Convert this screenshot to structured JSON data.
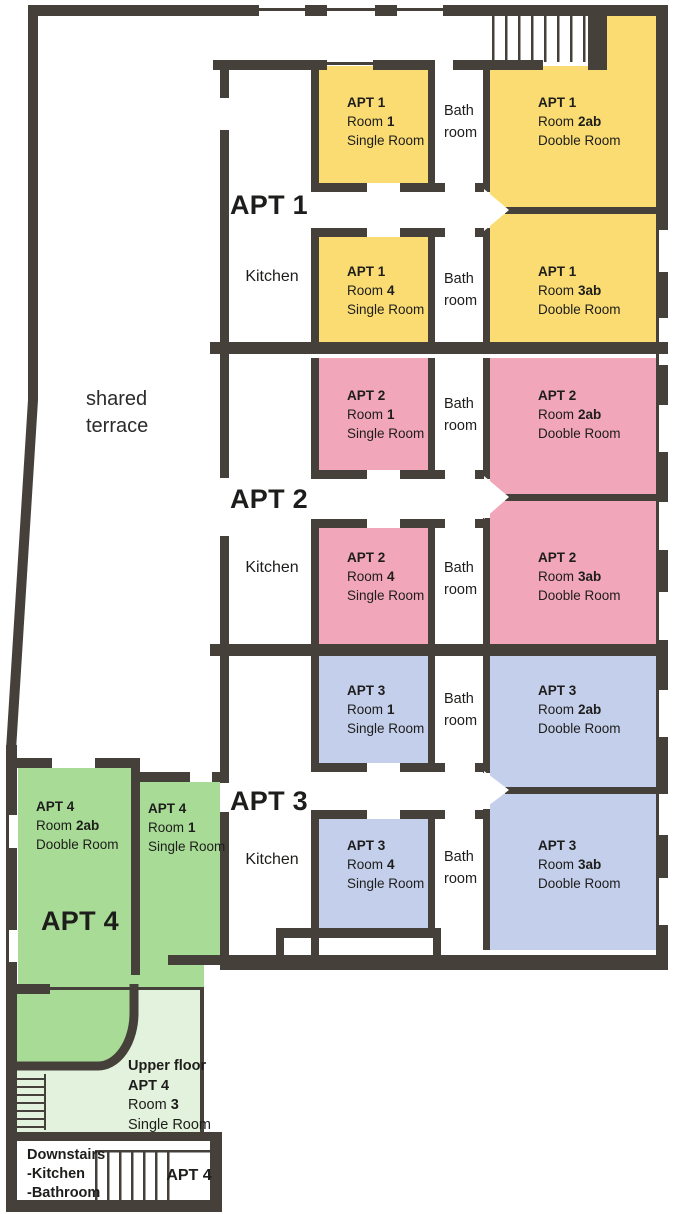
{
  "colors": {
    "apt1": "#FADC73",
    "apt2": "#F1A6BA",
    "apt3": "#C3CFEB",
    "apt4": "#A8DB96",
    "apt4-upper": "#E3F2DC",
    "wall": "#46403B"
  },
  "terrace": {
    "line1": "shared",
    "line2": "terrace"
  },
  "apartments": [
    {
      "name": "APT 1",
      "kitchen": "Kitchen",
      "bath": {
        "l1": "Bath",
        "l2": "room"
      },
      "rooms": {
        "room1": {
          "apt": "APT 1",
          "word": "Room",
          "num": "1",
          "type": "Single Room"
        },
        "room2ab": {
          "apt": "APT 1",
          "word": "Room",
          "num": "2ab",
          "type": "Dooble Room"
        },
        "room4": {
          "apt": "APT 1",
          "word": "Room",
          "num": "4",
          "type": "Single Room"
        },
        "room3ab": {
          "apt": "APT 1",
          "word": "Room",
          "num": "3ab",
          "type": "Dooble Room"
        }
      }
    },
    {
      "name": "APT 2",
      "kitchen": "Kitchen",
      "bath": {
        "l1": "Bath",
        "l2": "room"
      },
      "rooms": {
        "room1": {
          "apt": "APT 2",
          "word": "Room",
          "num": "1",
          "type": "Single Room"
        },
        "room2ab": {
          "apt": "APT 2",
          "word": "Room",
          "num": "2ab",
          "type": "Dooble Room"
        },
        "room4": {
          "apt": "APT 2",
          "word": "Room",
          "num": "4",
          "type": "Single Room"
        },
        "room3ab": {
          "apt": "APT 2",
          "word": "Room",
          "num": "3ab",
          "type": "Dooble Room"
        }
      }
    },
    {
      "name": "APT 3",
      "kitchen": "Kitchen",
      "bath": {
        "l1": "Bath",
        "l2": "room"
      },
      "rooms": {
        "room1": {
          "apt": "APT 3",
          "word": "Room",
          "num": "1",
          "type": "Single Room"
        },
        "room2ab": {
          "apt": "APT 3",
          "word": "Room",
          "num": "2ab",
          "type": "Dooble Room"
        },
        "room4": {
          "apt": "APT 3",
          "word": "Room",
          "num": "4",
          "type": "Single Room"
        },
        "room3ab": {
          "apt": "APT 3",
          "word": "Room",
          "num": "3ab",
          "type": "Dooble Room"
        }
      }
    }
  ],
  "apt4": {
    "name": "APT 4",
    "room2ab": {
      "apt": "APT 4",
      "word": "Room",
      "num": "2ab",
      "type": "Dooble Room"
    },
    "room1": {
      "apt": "APT 4",
      "word": "Room",
      "num": "1",
      "type": "Single Room"
    },
    "upper": {
      "title": "Upper floor",
      "apt": "APT 4",
      "word": "Room",
      "num": "3",
      "type": "Single Room"
    },
    "downstairs": {
      "title": "Downstairs",
      "items": [
        "-Kitchen",
        "-Bathroom"
      ]
    },
    "stair_label": "APT 4"
  }
}
